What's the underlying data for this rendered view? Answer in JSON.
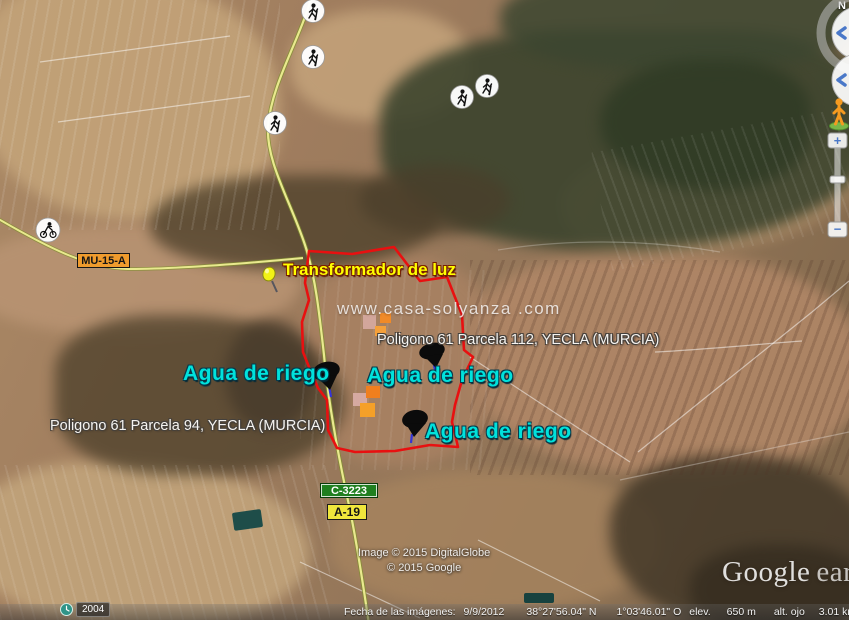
{
  "app": {
    "name": "Google Earth",
    "view": "satellite-oblique"
  },
  "map": {
    "watermark": "www.casa-solyanza .com",
    "labels": {
      "transformador": "Transformador de luz",
      "parcela_112": "Poligono 61 Parcela 112, YECLA (MURCIA)",
      "parcela_94": "Poligono 61 Parcela 94, YECLA (MURCIA)",
      "agua_de_riego": "Agua de riego"
    },
    "road_signs": [
      {
        "id": "mu-15-a",
        "label": "MU-15-A",
        "bg": "#ef9b2d",
        "fg": "#151515"
      },
      {
        "id": "c-3223",
        "label": "C-3223",
        "bg": "#1f7f1f",
        "fg": "#ffffff"
      },
      {
        "id": "a-19",
        "label": "A-19",
        "bg": "#f0e63c",
        "fg": "#151515"
      }
    ],
    "markers": {
      "yellow_pushpin_count": 1,
      "black_pushpin_count": 3,
      "hiker_marker_count": 5,
      "cyclist_marker_count": 1,
      "photo_overlay_squares": [
        "pink",
        "orange",
        "orange",
        "pink",
        "orange",
        "orange"
      ]
    }
  },
  "icons": {
    "hiker": "walking-person-icon",
    "cyclist": "cyclist-icon",
    "yellow_pushpin": "yellow-pushpin-icon",
    "black_pushpin": "black-pushpin-icon",
    "clock": "history-clock-icon",
    "pegman": "street-view-pegman-icon",
    "eye": "look-joystick-eye-icon",
    "hand": "move-joystick-hand-icon"
  },
  "nav": {
    "north_label": "N",
    "zoom_in": "+",
    "zoom_out": "−"
  },
  "time_badge": {
    "year": "2004"
  },
  "copyright": {
    "line1": "Image © 2015 DigitalGlobe",
    "line2": "© 2015 Google"
  },
  "logo": {
    "google": "Google",
    "earth": "earth"
  },
  "status_bar": {
    "imagery_date_label": "Fecha de las imágenes:",
    "imagery_date": "9/9/2012",
    "latitude": "38°27'56.04\" N",
    "longitude": "1°03'46.01\" O",
    "elev_label": "elev.",
    "elevation": "650 m",
    "eye_alt_label": "alt. ojo",
    "eye_altitude": "3.01 km"
  },
  "colors": {
    "parcel_outline": "#e81010",
    "label_yellow": "#ffff00",
    "label_cyan": "#00e2dc",
    "label_white": "#f5f3f0",
    "sign_orange": "#ef9b2d",
    "sign_green": "#1f7f1f",
    "sign_yellow": "#f0e63c",
    "pin_needle_blue": "#3434d8",
    "overlay_orange": "#f08a28",
    "overlay_pink": "#d8aca4",
    "road_fill": "#e9e98e"
  }
}
